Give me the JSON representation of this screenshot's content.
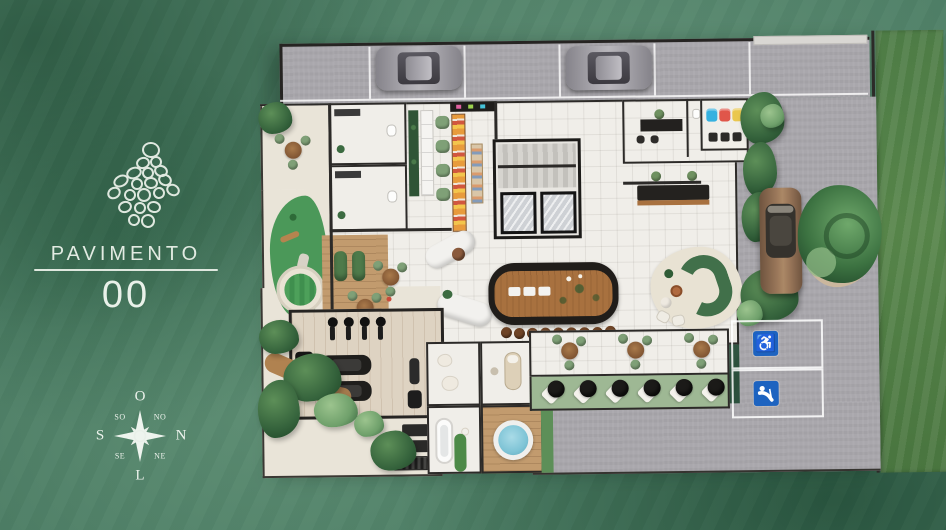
{
  "branding": {
    "title": "PAVIMENTO",
    "floor": "00"
  },
  "compass": {
    "west": "O",
    "north": "N",
    "east": "L",
    "south": "S",
    "northwest": "NO",
    "northeast": "NE",
    "southeast": "SE",
    "southwest": "SO"
  },
  "icons": {
    "wheelchair": "♿",
    "logo": "pebble-cluster-emblem",
    "compass_rose": "eight-point-star",
    "senior_parking": "person-with-cane"
  },
  "colors": {
    "background_green": "#4e7f66",
    "text_light": "#e7efe7",
    "pavement_gray": "#a9a7ac",
    "floor_white": "#f0eee9",
    "wall_dark": "#2c2a28",
    "bar_wood": "#a8713f",
    "deck_wood": "#c29b6e",
    "lawn_green": "#4c7a44",
    "foliage_dark": "#2f5c36",
    "play_green": "#4b9859",
    "spa_water": "#7fc4d6",
    "parking_sign_blue": "#1d63c0",
    "sage_green": "#7fa077",
    "cream_patio": "#e9e4d8",
    "car_gray": "#96949a",
    "car_brown": "#9a775a"
  }
}
